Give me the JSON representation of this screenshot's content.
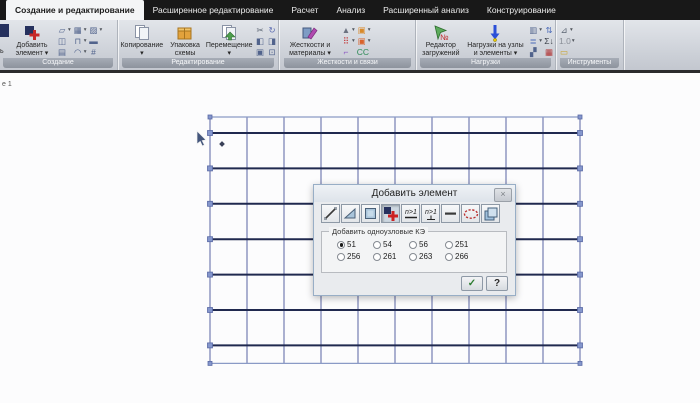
{
  "tab_bar": {
    "tabs": [
      {
        "name": "tab-create-and-edit",
        "label": "Создание и редактирование",
        "active": true
      },
      {
        "name": "tab-advanced-editing",
        "label": "Расширенное редактирование",
        "active": false
      },
      {
        "name": "tab-calculation",
        "label": "Расчет",
        "active": false
      },
      {
        "name": "tab-analysis",
        "label": "Анализ",
        "active": false
      },
      {
        "name": "tab-advanced-analysis",
        "label": "Расширенный анализ",
        "active": false
      },
      {
        "name": "tab-design",
        "label": "Конструирование",
        "active": false
      }
    ]
  },
  "ribbon": {
    "groups": [
      {
        "name": "group-create",
        "label": "Создание",
        "x": 0,
        "w": 117,
        "small_cols": 3,
        "clipped_label": "ь",
        "big_buttons": [
          {
            "name": "add-element-button",
            "icon": "add-element-icon",
            "lines": [
              "Добавить",
              "элемент ▾"
            ],
            "w": 46
          }
        ],
        "small_icons": [
          {
            "name": "create-surface-icon",
            "glyph": "▱",
            "dd": true
          },
          {
            "name": "create-mesh-icon",
            "glyph": "▦",
            "dd": true
          },
          {
            "name": "create-hatch-icon",
            "glyph": "▨",
            "dd": true
          },
          {
            "name": "create-frame-icon",
            "glyph": "◫",
            "dd": false
          },
          {
            "name": "create-arch-icon",
            "glyph": "⊓",
            "dd": true
          },
          {
            "name": "create-solid-icon",
            "glyph": "▬",
            "dd": false
          },
          {
            "name": "create-building-icon",
            "glyph": "▤",
            "dd": false
          },
          {
            "name": "create-dome-icon",
            "glyph": "◠",
            "dd": true
          },
          {
            "name": "create-truss-icon",
            "glyph": "#",
            "dd": false
          }
        ]
      },
      {
        "name": "group-editing",
        "label": "Редактирование",
        "x": 119,
        "w": 159,
        "small_cols": 2,
        "big_buttons": [
          {
            "name": "copy-button",
            "icon": "copy-icon",
            "lines": [
              "Копирование",
              "▾"
            ],
            "w": 47
          },
          {
            "name": "pack-scheme-button",
            "icon": "package-icon",
            "lines": [
              "Упаковка",
              "схемы"
            ],
            "w": 42
          },
          {
            "name": "move-button",
            "icon": "move-icon",
            "lines": [
              "Перемещение",
              "▾"
            ],
            "w": 49
          }
        ],
        "small_icons": [
          {
            "name": "cut-icon",
            "glyph": "✂",
            "dd": false,
            "color": "#5a6472"
          },
          {
            "name": "rotate-icon",
            "glyph": "↻",
            "dd": false,
            "color": "#5a6ab0"
          },
          {
            "name": "copy-fragment-icon",
            "glyph": "◧",
            "dd": false
          },
          {
            "name": "mirror-icon",
            "glyph": "◨",
            "dd": false
          },
          {
            "name": "stamp-icon",
            "glyph": "▣",
            "dd": false
          },
          {
            "name": "select-region-icon",
            "glyph": "⊡",
            "dd": false
          }
        ]
      },
      {
        "name": "group-stiffness-ties",
        "label": "Жесткости и связи",
        "x": 281,
        "w": 134,
        "small_cols": 2,
        "big_buttons": [
          {
            "name": "stiffness-materials-button",
            "icon": "stiffness-icon",
            "lines": [
              "Жесткости и",
              "материалы ▾"
            ],
            "w": 58
          }
        ],
        "small_icons": [
          {
            "name": "rigid-body-icon",
            "glyph": "▲",
            "dd": true,
            "color": "#6b7280"
          },
          {
            "name": "joint-a-icon",
            "glyph": "▣",
            "dd": true,
            "color": "#d98a2b"
          },
          {
            "name": "red-dots-icon",
            "glyph": "⠿",
            "dd": true,
            "color": "#c23434"
          },
          {
            "name": "joint-b-icon",
            "glyph": "▣",
            "dd": true,
            "color": "#d9632b"
          },
          {
            "name": "hinge-icon",
            "glyph": "⌐",
            "dd": false,
            "color": "#8a55c2"
          },
          {
            "name": "ties-cc-icon",
            "glyph": "CC",
            "dd": false,
            "color": "#2e8b57"
          }
        ]
      },
      {
        "name": "group-loads",
        "label": "Нагрузки",
        "x": 417,
        "w": 138,
        "small_cols": 2,
        "big_buttons": [
          {
            "name": "loadcase-editor-button",
            "icon": "loadcase-icon",
            "lines": [
              "Редактор",
              "загружений"
            ],
            "w": 48
          },
          {
            "name": "loads-on-nodes-button",
            "icon": "loads-icon",
            "lines": [
              "Нагрузки на узлы",
              "и элементы ▾"
            ],
            "w": 62
          }
        ],
        "small_icons": [
          {
            "name": "load-list-icon",
            "glyph": "▥",
            "dd": true
          },
          {
            "name": "load-updown-icon",
            "glyph": "⇅",
            "dd": false,
            "color": "#4a6ab8"
          },
          {
            "name": "load-table-icon",
            "glyph": "≣",
            "dd": true,
            "color": "#4a6ab8"
          },
          {
            "name": "load-sum-icon",
            "glyph": "Σ↓",
            "dd": false,
            "color": "#3a3f48"
          },
          {
            "name": "load-brush-icon",
            "glyph": "▞",
            "dd": false
          },
          {
            "name": "load-red-icon",
            "glyph": "▦",
            "dd": false,
            "color": "#b03030"
          }
        ]
      },
      {
        "name": "group-tools",
        "label": "Инструменты",
        "x": 557,
        "w": 66,
        "small_cols": 1,
        "big_buttons": [],
        "small_icons": [
          {
            "name": "measure-icon",
            "glyph": "⊿",
            "dd": true,
            "color": "#5a6472"
          },
          {
            "name": "units-icon",
            "glyph": "1.0",
            "dd": true,
            "color": "#8a8f98"
          },
          {
            "name": "ruler-icon",
            "glyph": "▭",
            "dd": false,
            "color": "#c9a227"
          }
        ]
      }
    ]
  },
  "workspace": {
    "view_label": "е 1"
  },
  "dialog": {
    "title": "Добавить элемент",
    "close_glyph": "×",
    "tools": [
      {
        "name": "rod-element-tool",
        "type": "rod",
        "active": false
      },
      {
        "name": "triangle-element-tool",
        "type": "tri",
        "active": false
      },
      {
        "name": "quad-element-tool",
        "type": "quad",
        "active": false
      },
      {
        "name": "single-node-element-tool",
        "type": "node",
        "active": true
      },
      {
        "name": "rod-n1-tool",
        "type": "n1a",
        "active": false,
        "text": "n>1"
      },
      {
        "name": "node-n1-tool",
        "type": "n1b",
        "active": false,
        "text": "n>1"
      },
      {
        "name": "dash-element-tool",
        "type": "dash",
        "active": false
      },
      {
        "name": "ellipse-element-tool",
        "type": "ellipse",
        "active": false
      },
      {
        "name": "volume-element-tool",
        "type": "cube",
        "active": false
      }
    ],
    "groupbox_label": "Добавить одноузловые КЭ",
    "radio_options": [
      {
        "label": "51",
        "checked": true
      },
      {
        "label": "54",
        "checked": false
      },
      {
        "label": "56",
        "checked": false
      },
      {
        "label": "251",
        "checked": false
      },
      {
        "label": "256",
        "checked": false
      },
      {
        "label": "261",
        "checked": false
      },
      {
        "label": "263",
        "checked": false
      },
      {
        "label": "266",
        "checked": false
      }
    ],
    "apply_glyph": "✓",
    "help_glyph": "?"
  },
  "model": {
    "grid": {
      "left": 210,
      "top": 44,
      "columns": 10,
      "col_width": 37,
      "node_rows": 7,
      "row_height": 35.4,
      "top_strip": 16,
      "bottom_strip": 18
    },
    "colors": {
      "vertical_line": "#7f88b8",
      "horizontal_line": "#20294f",
      "edge_line": "#8a9ac6",
      "node_fill": "#8496cc",
      "node_border": "#5a6aa5"
    },
    "cursor": {
      "x": 197,
      "y": 58
    },
    "point_marker": {
      "x": 222,
      "y": 71
    }
  }
}
